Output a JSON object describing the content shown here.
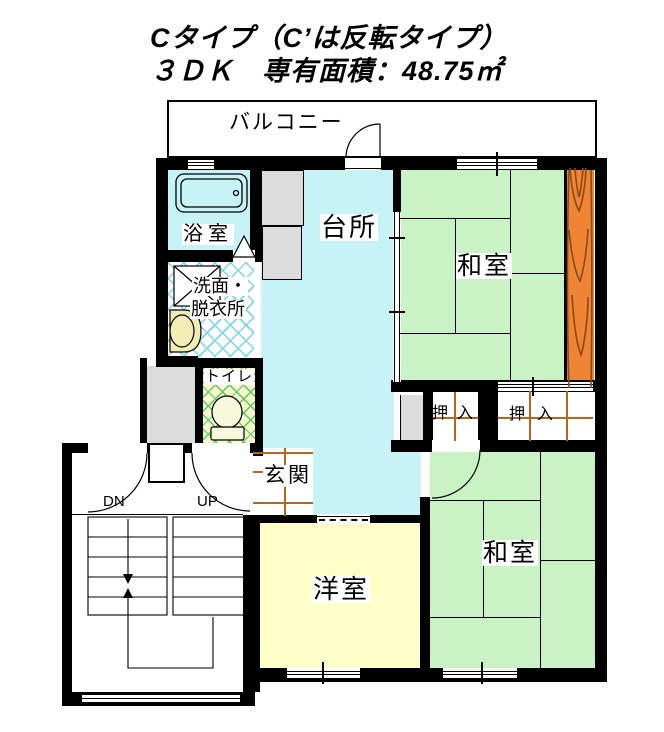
{
  "title": {
    "line1": "Cタイプ（C’は反転タイプ）",
    "line2": "３ＤＫ　専有面積：48.75㎡"
  },
  "rooms": {
    "balcony": "バルコニー",
    "bathroom": "浴室",
    "kitchen": "台所",
    "washitsu_upper": "和室",
    "washroom_line1": "洗面・",
    "washroom_line2": "脱衣所",
    "toilet": "トイレ",
    "oshiire_left": "押入",
    "oshiire_right": "押入",
    "genkan": "玄関",
    "yoshitsu": "洋室",
    "washitsu_lower": "和室",
    "stairs_down": "DN",
    "stairs_up": "UP"
  },
  "colors": {
    "wall_black": "#000000",
    "room_cyan": "#c7f3f7",
    "tatami_green": "#c9f3c5",
    "western_yellow": "#ffffc9",
    "wood_orange": "#ef8434",
    "wood_grain": "#8a4a15",
    "grid_brown": "#b5651d",
    "lattice_cyan": "#79d7e6",
    "lattice_green": "#5cc75c",
    "gray_fixture": "#dcdcdc"
  }
}
